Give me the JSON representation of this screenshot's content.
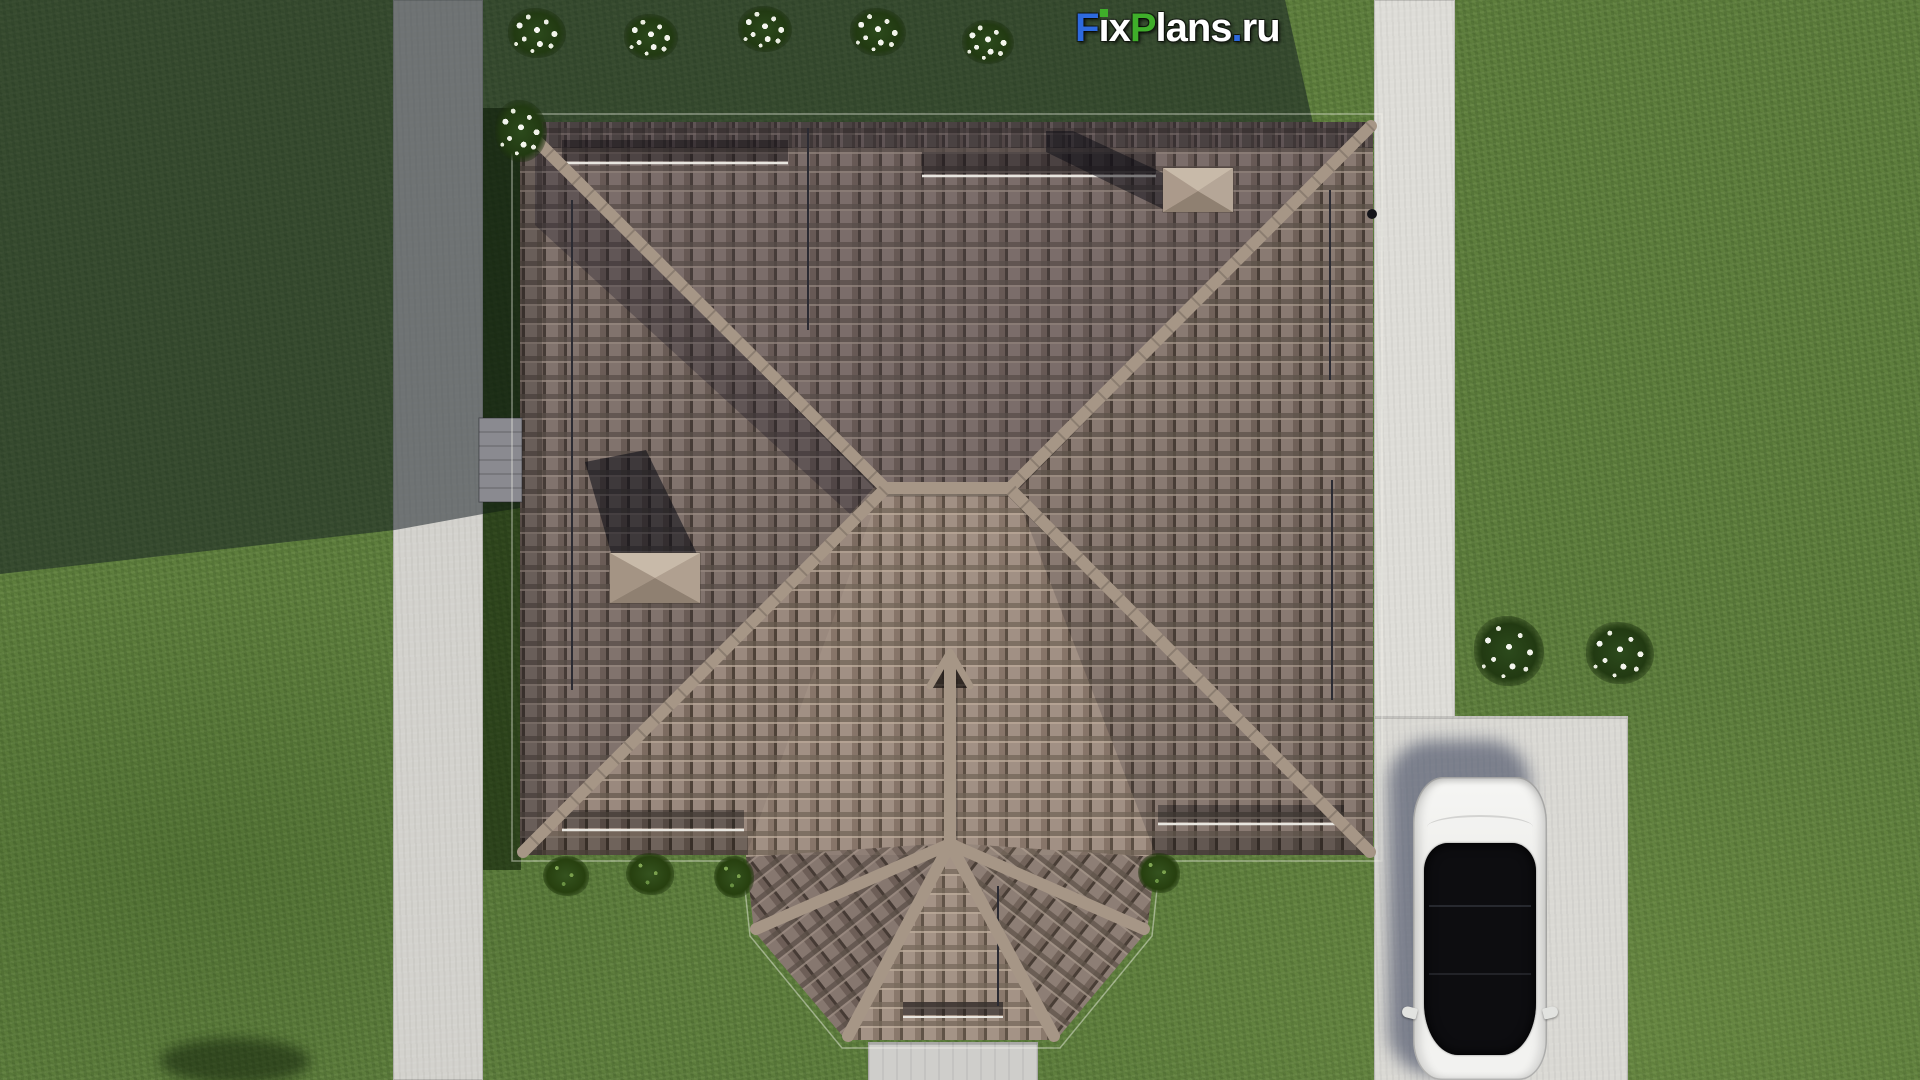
{
  "watermark": {
    "full_text": "FixPlans.ru",
    "parts": [
      {
        "text": "F",
        "color": "#2e6ade"
      },
      {
        "text": "i",
        "color": "#ffffff",
        "dot_color": "#3fae2a"
      },
      {
        "text": "x",
        "color": "#ffffff"
      },
      {
        "text": "P",
        "color": "#3fae2a"
      },
      {
        "text": "lans",
        "color": "#ffffff"
      },
      {
        "text": ".",
        "color": "#2e6ade"
      },
      {
        "text": "ru",
        "color": "#ffffff"
      }
    ]
  },
  "palette": {
    "grass-base": "#5e7e3d",
    "path-concrete": "#d3d2cd",
    "path-bright": "#deddd8",
    "driveway": "#dad9d4",
    "walkway": "#cfcecb",
    "roof-base": "#9a897e",
    "roof-dark-col": "#7d6c61",
    "roof-gap": "#4e4238",
    "roof-row-shadow": "#675a4e",
    "roof-row-light": "#b3a294",
    "roof-ridge": "#a69686",
    "chimney-light": "#c8baa9",
    "chimney-base": "#b5a697",
    "chimney-dark": "#8f8071",
    "rail": "#e8e6e0",
    "conductor": "#2b2b33",
    "canopy": "#8a8a90",
    "car-body": "#f2f2f1",
    "car-glass": "#0d0d10",
    "car-shadow": "#39415a",
    "bush-green": "#2c4a1c",
    "shrub-green": "#35531f",
    "flower-white": "#f2f4ee"
  }
}
